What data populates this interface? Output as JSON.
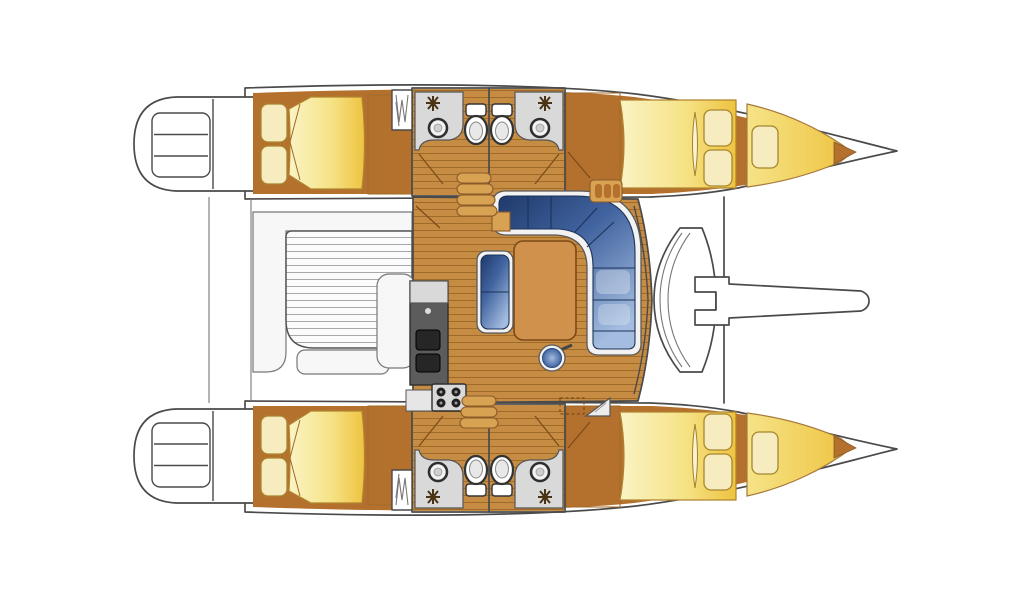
{
  "image": {
    "description": "Catamaran sailboat interior floor plan, overhead deck view, bow pointing right",
    "boat_type": "catamaran",
    "view": "overhead-deck-plan"
  },
  "features": [
    "port-hull",
    "starboard-hull",
    "transom-swim-steps",
    "aft-cabin-double-bed",
    "hanging-locker",
    "bathroom-counter",
    "bathroom-sink",
    "bathroom-toilet",
    "forward-cabin-double-bed",
    "forepeak-berth",
    "bow-point",
    "salon-floor",
    "l-shaped-settee",
    "salon-table",
    "settee-bench",
    "salon-stool",
    "galley-counter",
    "stove-4-burner",
    "galley-sink-unit",
    "companionway-steps-port",
    "companionway-steps-starboard",
    "louver-locker",
    "hatch-dashed",
    "step-triangle",
    "cockpit-bench",
    "cockpit-slatted-table",
    "cockpit-module",
    "aft-deck-lines",
    "foredeck-seat",
    "forward-crossbeam",
    "bowsprit"
  ],
  "colors": {
    "pageBg": "#ffffff",
    "outline": "#4a4a4a",
    "hullWhite": "#ffffff",
    "wood": "#c68c44",
    "woodLine": "#a06a28",
    "woodTrim": "#b4702d",
    "woodLight": "#d8a253",
    "bedPale": "#faf3c4",
    "bedMid": "#f6e387",
    "bedGold": "#eec33f",
    "pillow": "#f6ecc0",
    "pillowEdge": "#a8862e",
    "blueDark": "#1f3a6b",
    "blueMid": "#41639f",
    "blueLight": "#a3bcdf",
    "trimWhite": "#f2f2f2",
    "benchWhite": "#f7f7f7",
    "grayCounter": "#d9d9d9",
    "grayDark": "#5c5c5c",
    "slatBg": "#fbfbfb",
    "slatLine": "#a8a8a8",
    "tableWood": "#d0914c",
    "tableEdge": "#7c4a16",
    "doorLine": "#7a4a1a"
  }
}
